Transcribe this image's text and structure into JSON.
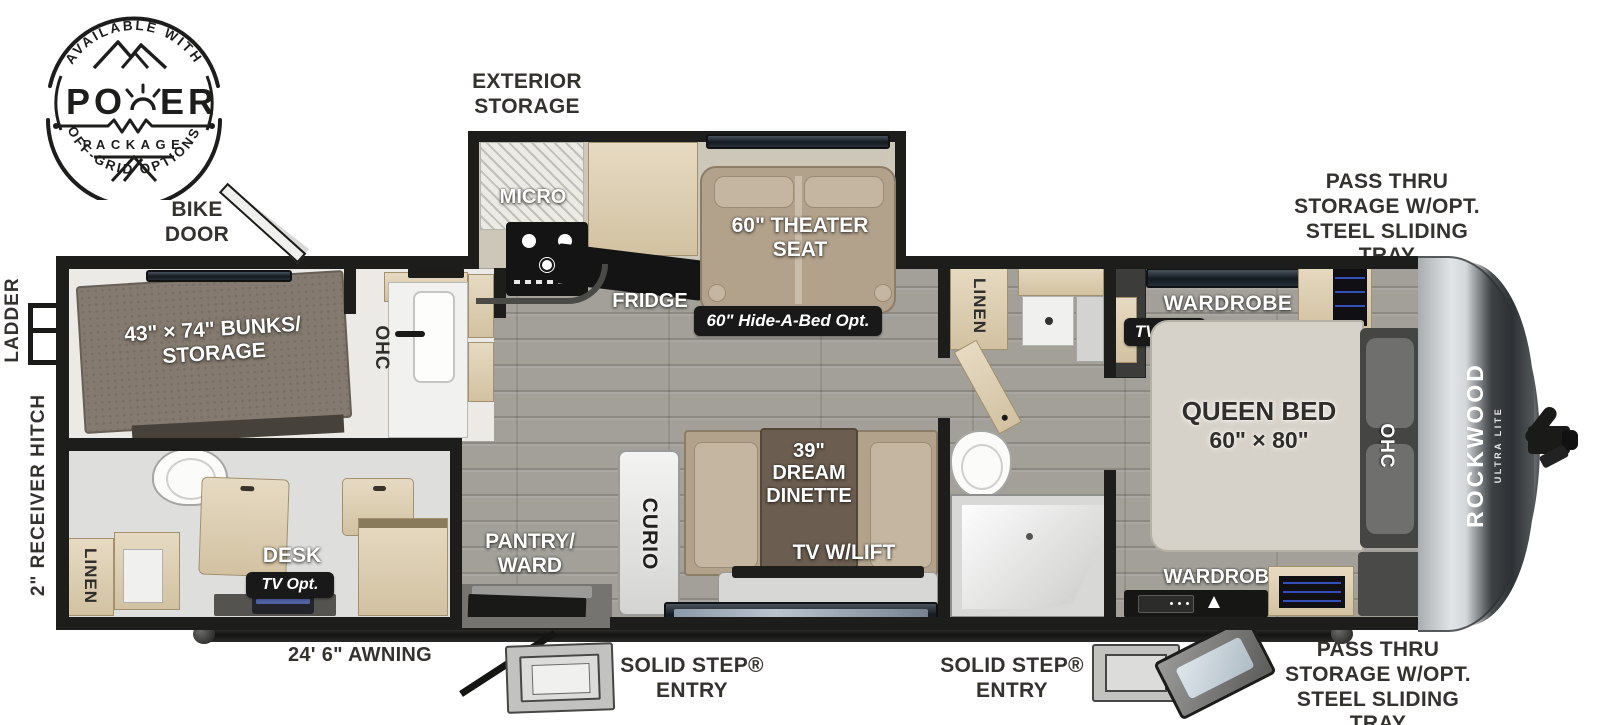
{
  "badge": {
    "arc_top": "AVAILABLE WITH",
    "power_left": "PO",
    "power_right": "ER",
    "package": "PACKAGE",
    "arc_bottom": "OFF-GRID OPTIONS"
  },
  "exterior": {
    "storage": [
      "EXTERIOR",
      "STORAGE"
    ],
    "bike_door": [
      "BIKE",
      "DOOR"
    ],
    "ladder": "LADDER",
    "receiver_hitch": "2\" RECEIVER HITCH",
    "pass_thru_top": [
      "PASS THRU",
      "STORAGE W/OPT.",
      "STEEL SLIDING TRAY"
    ],
    "pass_thru_bottom": [
      "PASS THRU",
      "STORAGE W/OPT.",
      "STEEL SLIDING TRAY"
    ],
    "awning": "24' 6\" AWNING",
    "entry_front": [
      "SOLID STEP®",
      "ENTRY"
    ],
    "entry_rear": [
      "SOLID STEP®",
      "ENTRY"
    ]
  },
  "interior": {
    "bunks": [
      "43\" × 74\" BUNKS/",
      "STORAGE"
    ],
    "ohc_bath": "OHC",
    "ohc_bedroom": "OHC",
    "linen_rear": "LINEN",
    "linen_bath": "LINEN",
    "desk": "DESK",
    "desk_tv_opt": "TV Opt.",
    "pantry": [
      "PANTRY/",
      "WARD"
    ],
    "curio": "CURIO",
    "micro": "MICRO",
    "fridge": "FRIDGE",
    "theater_seat": [
      "60\" THEATER",
      "SEAT"
    ],
    "hide_a_bed": "60\" Hide-A-Bed Opt.",
    "dinette": [
      "39\"",
      "DREAM",
      "DINETTE"
    ],
    "tv_lift": "TV W/LIFT",
    "wardrobe_top": "WARDROBE",
    "wardrobe_bottom": "WARDROBE",
    "bedroom_tv_opt": "TV Opt.",
    "queen_bed": [
      "QUEEN BED",
      "60\" × 80\""
    ]
  },
  "brand": {
    "name": "ROCKWOOD",
    "series": "ULTRA LITE"
  },
  "colors": {
    "wall": "#1d1d1b",
    "wood_cabinet": "#ddd0b6",
    "floor_wood": "#a3a09a",
    "upholstery": "#b2a28c",
    "badge_bg": "#191919",
    "led_accent": "#3450b8"
  }
}
